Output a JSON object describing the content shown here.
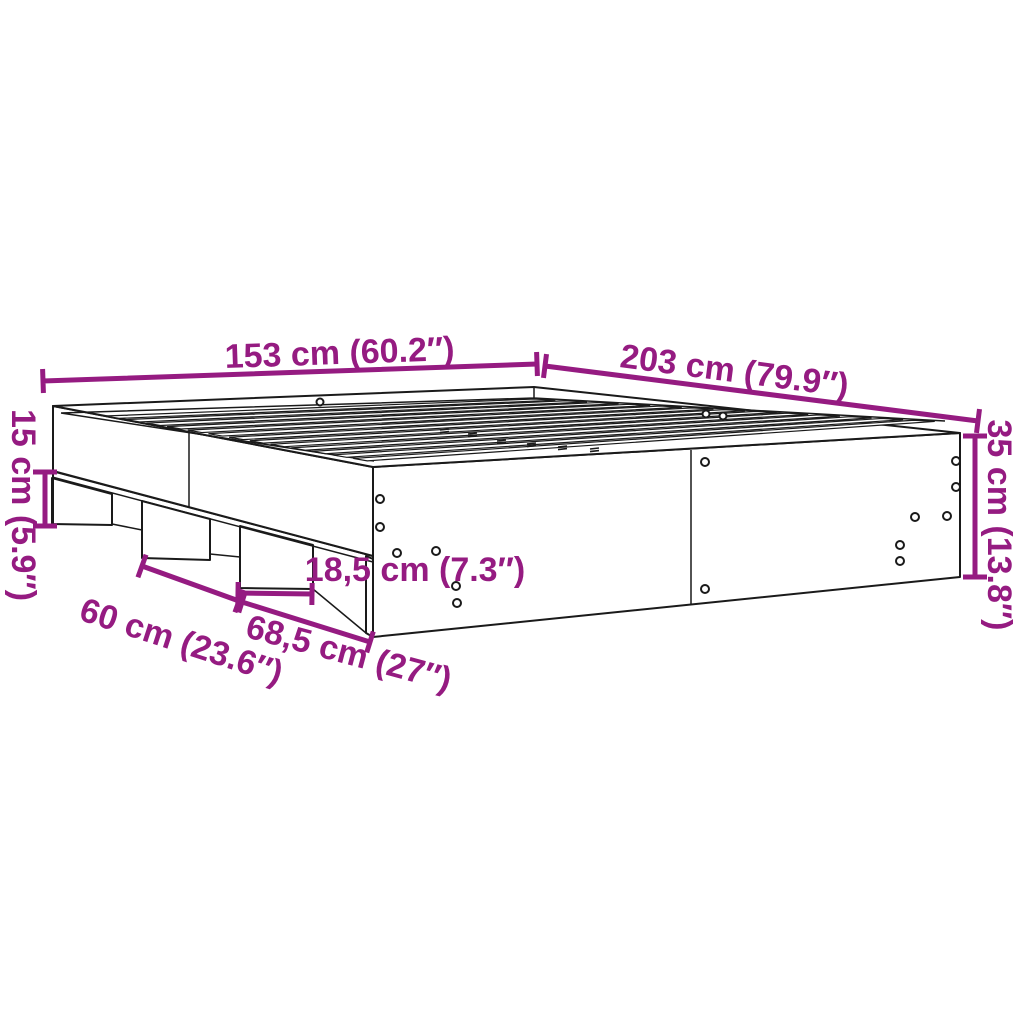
{
  "diagram": {
    "type": "product-dimension-diagram",
    "subject": "bed-frame-with-plinth-supports",
    "colors": {
      "accent": "#951B81",
      "line": "#1a1a1a",
      "background": "#ffffff"
    },
    "dimensions": [
      {
        "name": "frame-width",
        "label": "153 cm (60.2″)"
      },
      {
        "name": "frame-length",
        "label": "203 cm (79.9″)"
      },
      {
        "name": "plinth-height",
        "label": "15 cm (5.9″)"
      },
      {
        "name": "total-height",
        "label": "35 cm (13.8″)"
      },
      {
        "name": "support-block-width",
        "label": "18,5 cm (7.3″)"
      },
      {
        "name": "support-spacing",
        "label": "60 cm (23.6″)"
      },
      {
        "name": "corner-opening-width",
        "label": "68,5 cm (27″)"
      }
    ]
  }
}
